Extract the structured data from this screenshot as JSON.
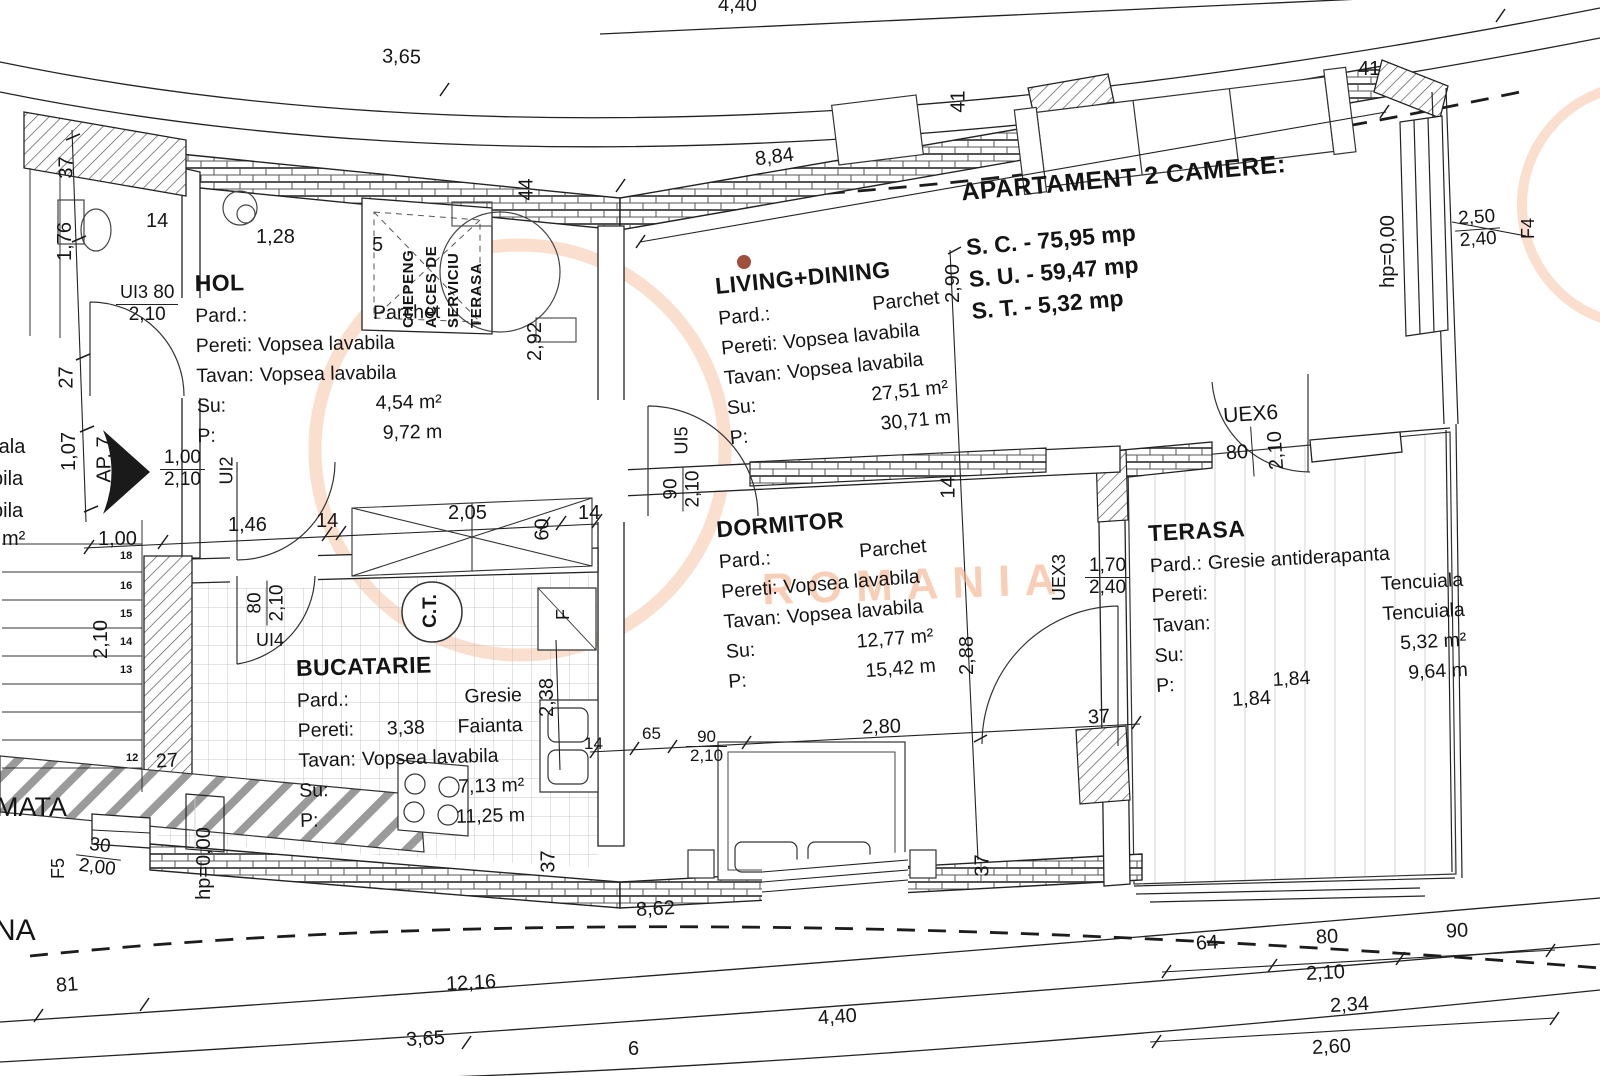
{
  "title_block": {
    "title": "APARTAMENT 2 CAMERE:",
    "sc": "S. C. - 75,95 mp",
    "su": "S. U. - 59,47 mp",
    "st": "S. T. - 5,32 mp"
  },
  "rooms": {
    "hol": {
      "name": "HOL",
      "pard_label": "Pard.:",
      "pard": "Parchet",
      "pereti_label": "Pereti:",
      "pereti": "Vopsea lavabila",
      "tavan_label": "Tavan:",
      "tavan": "Vopsea lavabila",
      "su_label": "Su:",
      "su": "4,54 m²",
      "p_label": "P:",
      "p": "9,72 m"
    },
    "living": {
      "name": "LIVING+DINING",
      "pard_label": "Pard.:",
      "pard": "Parchet",
      "pereti_label": "Pereti:",
      "pereti": "Vopsea lavabila",
      "tavan_label": "Tavan:",
      "tavan": "Vopsea lavabila",
      "su_label": "Su:",
      "su": "27,51 m²",
      "p_label": "P:",
      "p": "30,71 m"
    },
    "dormitor": {
      "name": "DORMITOR",
      "pard_label": "Pard.:",
      "pard": "Parchet",
      "pereti_label": "Pereti:",
      "pereti": "Vopsea lavabila",
      "tavan_label": "Tavan:",
      "tavan": "Vopsea lavabila",
      "su_label": "Su:",
      "su": "12,77 m²",
      "p_label": "P:",
      "p": "15,42 m"
    },
    "bucatarie": {
      "name": "BUCATARIE",
      "pard_label": "Pard.:",
      "pard": "Gresie",
      "pereti_label": "Pereti:",
      "pereti_dim": "3,38",
      "pereti": "Faianta",
      "tavan_label": "Tavan:",
      "tavan": "Vopsea lavabila",
      "su_label": "Su:",
      "su": "7,13 m²",
      "p_label": "P:",
      "p": "11,25 m"
    },
    "terasa": {
      "name": "TERASA",
      "pard_label": "Pard.:",
      "pard": "Gresie antiderapanta",
      "pereti_label": "Pereti:",
      "pereti": "Tencuiala",
      "tavan_label": "Tavan:",
      "tavan": "Tencuiala",
      "su_label": "Su:",
      "su": "5,32 m²",
      "p_label": "P:",
      "p_dim": "1,84",
      "p": "9,64 m"
    }
  },
  "chepeng": {
    "l1": "CHEPENG",
    "l2": "ACCES DE",
    "l3": "SERVICIU",
    "l4": "TERASA"
  },
  "openings": {
    "ui2": {
      "id": "UI2",
      "w": "1,00",
      "h": "2,10"
    },
    "ui3": {
      "id": "UI3",
      "w": "80",
      "h": "2,10"
    },
    "ui4": {
      "id": "UI4",
      "w": "80",
      "h": "2,10"
    },
    "ui5": {
      "id": "UI5",
      "w": "90",
      "h": "2,10"
    },
    "uex3": {
      "id": "UEX3",
      "w": "1,70",
      "h": "2,40"
    },
    "uex6": {
      "id": "UEX6",
      "w": "80",
      "h": "2,10"
    },
    "f4": {
      "id": "F4",
      "w": "2,50",
      "h": "2,40"
    },
    "f5": {
      "id": "F5",
      "w": "30",
      "h": "2,00"
    }
  },
  "labels": {
    "ap7": "AP. 7",
    "hp_right": "hp=0,00",
    "hp_left": "hp=0,00",
    "ct": "C.T.",
    "f": "F",
    "mata": "MATA",
    "na": "NA",
    "partial1": "rala",
    "partial2": "bila",
    "partial3": "bila",
    "partial4": "m²",
    "watermark": "ROMANIA"
  },
  "dims": {
    "top440": "4,40",
    "top365": "3,65",
    "d884": "8,84",
    "d41a": "41",
    "d41b": "41",
    "d44": "44",
    "d5": "5",
    "d128": "1,28",
    "d14a": "14",
    "d37a": "37",
    "d176": "1,76",
    "d27a": "27",
    "d107": "1,07",
    "d292": "2,92",
    "d290": "2,90",
    "d100b": "1,00",
    "d146": "1,46",
    "d14b": "14",
    "d205": "2,05",
    "d60": "60",
    "d14c": "14",
    "d238": "2,38",
    "d14d": "14",
    "d288": "2,88",
    "d37b": "37",
    "d37c": "37",
    "d37d": "37",
    "d184": "1,84",
    "d14e": "14",
    "d65": "65",
    "d90": "90",
    "d210a": "2,10",
    "d280": "2,80",
    "d862": "8,62",
    "d81": "81",
    "d1216": "12,16",
    "d365b": "3,65",
    "d440b": "4,40",
    "d6": "6",
    "d64": "64",
    "d80": "80",
    "d90b": "90",
    "d210b": "2,10",
    "d234": "2,34",
    "d260": "2,60",
    "d27b": "27",
    "d210s": "2,10"
  },
  "stairs": {
    "a": "18",
    "b": "16",
    "c": "15",
    "d": "14",
    "e": "13",
    "f": "12"
  },
  "colors": {
    "line": "#222222",
    "watermark": "#f4b08a",
    "dot": "#973b28"
  }
}
